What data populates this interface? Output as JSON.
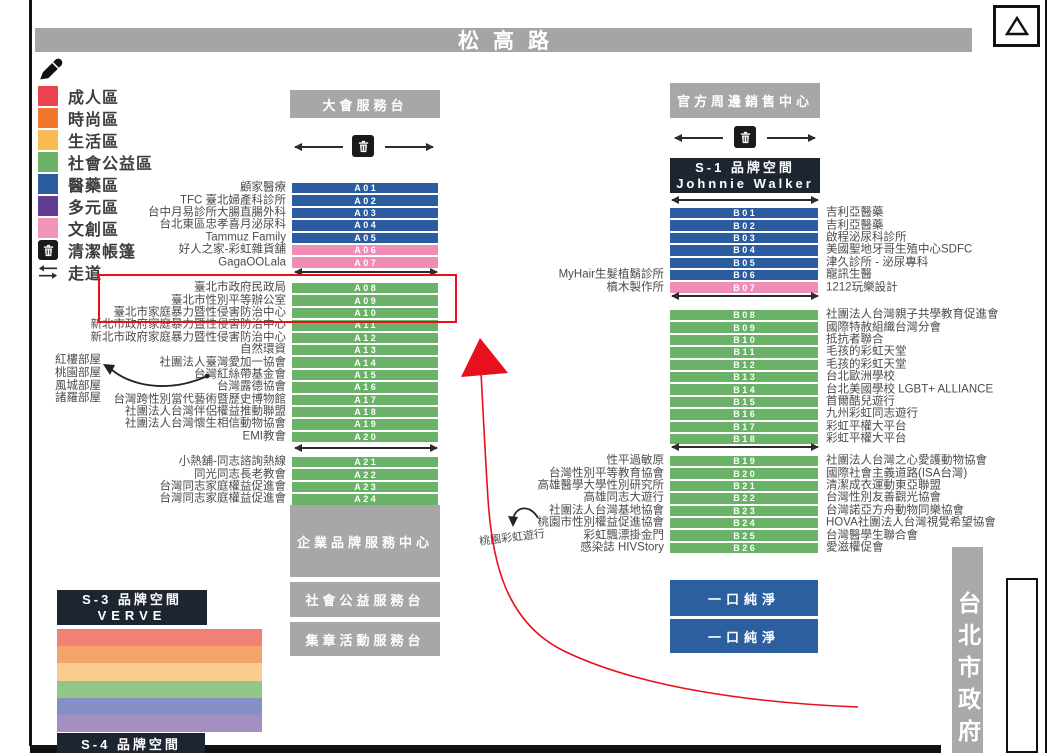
{
  "street": {
    "name": "松高路"
  },
  "legend": {
    "items": [
      {
        "label": "成人區",
        "color": "#e8434e"
      },
      {
        "label": "時尚區",
        "color": "#f2762b"
      },
      {
        "label": "生活區",
        "color": "#f8bc55"
      },
      {
        "label": "社會公益區",
        "color": "#6cb368"
      },
      {
        "label": "醫藥區",
        "color": "#2b5c9f"
      },
      {
        "label": "多元區",
        "color": "#613c90"
      },
      {
        "label": "文創區",
        "color": "#f294ba"
      }
    ],
    "trash_label": "清潔帳篷",
    "aisle_label": "走道",
    "aisle_glyph": "⇆"
  },
  "zones": {
    "info_desk": "大會服務台",
    "merch_center": "官方周邊銷售中心",
    "s1_line1": "S-1 品牌空間",
    "s1_line2": "Johnnie Walker",
    "s3_line1": "S-3 品牌空間",
    "s3_line2": "VERVE",
    "s4_line1": "S-4 品牌空間",
    "corp_center": "企業品牌服務中心",
    "social_desk": "社會公益服務台",
    "stamp_desk": "集章活動服務台",
    "pure_sip_1": "一口純淨",
    "pure_sip_2": "一口純淨",
    "city_hall": "台北市政府",
    "triangle_marker": "△"
  },
  "booths": {
    "a1": [
      {
        "code": "A01",
        "label_left": "顧家醫療",
        "color": "#2b5c9f"
      },
      {
        "code": "A02",
        "label_left": "TFC 臺北婦產科診所",
        "color": "#2b5c9f"
      },
      {
        "code": "A03",
        "label_left": "台中月易診所大腸直腸外科",
        "color": "#2b5c9f"
      },
      {
        "code": "A04",
        "label_left": "台北東區忠孝喜月泌尿科",
        "color": "#2b5c9f"
      },
      {
        "code": "A05",
        "label_left": "Tammuz Family",
        "color": "#2b5c9f"
      },
      {
        "code": "A06",
        "label_left": "好人之家-彩虹雜貨舖",
        "color": "#f18cb7"
      },
      {
        "code": "A07",
        "label_left": "GagaOOLala",
        "color": "#f18cb7"
      }
    ],
    "a2": [
      {
        "code": "A08",
        "label_left": "臺北市政府民政局",
        "color": "#69b267"
      },
      {
        "code": "A09",
        "label_left": "臺北市性別平等辦公室",
        "color": "#69b267"
      },
      {
        "code": "A10",
        "label_left": "臺北市家庭暴力暨性侵害防治中心",
        "color": "#69b267"
      },
      {
        "code": "A11",
        "label_left": "新北市政府家庭暴力暨性侵害防治中心",
        "color": "#69b267"
      },
      {
        "code": "A12",
        "label_left": "新北市政府家庭暴力暨性侵害防治中心",
        "color": "#69b267"
      },
      {
        "code": "A13",
        "label_left": "自然環資",
        "color": "#69b267"
      },
      {
        "code": "A14",
        "label_left": "社團法人臺灣愛加一協會",
        "color": "#69b267"
      },
      {
        "code": "A15",
        "label_left": "台灣紅絲帶基金會",
        "color": "#69b267"
      },
      {
        "code": "A16",
        "label_left": "台灣露德協會",
        "color": "#69b267"
      },
      {
        "code": "A17",
        "label_left": "台灣跨性別當代藝術暨歷史博物館",
        "color": "#69b267"
      },
      {
        "code": "A18",
        "label_left": "社團法人台灣伴侶權益推動聯盟",
        "color": "#69b267"
      },
      {
        "code": "A19",
        "label_left": "社團法人台灣懷生相信動物協會",
        "color": "#69b267"
      },
      {
        "code": "A20",
        "label_left": "EMI教會",
        "color": "#69b267"
      }
    ],
    "a3": [
      {
        "code": "A21",
        "label_left": "小熱舖-同志諮詢熱線",
        "color": "#69b267"
      },
      {
        "code": "A22",
        "label_left": "同光同志長老教會",
        "color": "#69b267"
      },
      {
        "code": "A23",
        "label_left": "台灣同志家庭權益促進會",
        "color": "#69b267"
      },
      {
        "code": "A24",
        "label_left": "台灣同志家庭權益促進會",
        "color": "#69b267"
      }
    ],
    "b1": [
      {
        "code": "B01",
        "label_right": "吉利亞醫藥",
        "color": "#2b5c9f"
      },
      {
        "code": "B02",
        "label_right": "吉利亞醫藥",
        "color": "#2b5c9f"
      },
      {
        "code": "B03",
        "label_right": "啟程泌尿科診所",
        "color": "#2b5c9f"
      },
      {
        "code": "B04",
        "label_right": "美國聖地牙哥生殖中心SDFC",
        "color": "#2b5c9f"
      },
      {
        "code": "B05",
        "label_right": "津久診所 - 泌尿專科",
        "color": "#2b5c9f"
      },
      {
        "code": "B06",
        "label_left": "MyHair生髮植鬍診所",
        "label_right": "寵訊生醫",
        "color": "#2b5c9f"
      },
      {
        "code": "B07",
        "label_left": "槙木製作所",
        "label_right": "1212玩樂設計",
        "color": "#f18cb7"
      }
    ],
    "b2": [
      {
        "code": "B08",
        "label_right": "社團法人台灣親子共學教育促進會",
        "color": "#69b267"
      },
      {
        "code": "B09",
        "label_right": "國際特赦組織台灣分會",
        "color": "#69b267"
      },
      {
        "code": "B10",
        "label_right": "抵抗者聯合",
        "color": "#69b267"
      },
      {
        "code": "B11",
        "label_right": "毛孩的彩虹天堂",
        "color": "#69b267"
      },
      {
        "code": "B12",
        "label_right": "毛孩的彩虹天堂",
        "color": "#69b267"
      },
      {
        "code": "B13",
        "label_right": "台北歐洲學校",
        "color": "#69b267"
      },
      {
        "code": "B14",
        "label_right": "台北美國學校 LGBT+ ALLIANCE",
        "color": "#69b267"
      },
      {
        "code": "B15",
        "label_right": "首爾酷兒遊行",
        "color": "#69b267"
      },
      {
        "code": "B16",
        "label_right": "九州彩虹同志遊行",
        "color": "#69b267"
      },
      {
        "code": "B17",
        "label_right": "彩虹平權大平台",
        "color": "#69b267"
      },
      {
        "code": "B18",
        "label_right": "彩虹平權大平台",
        "color": "#69b267"
      }
    ],
    "b3": [
      {
        "code": "B19",
        "label_left": "性平過敏原",
        "label_right": "社團法人台灣之心愛護動物協會",
        "color": "#69b267"
      },
      {
        "code": "B20",
        "label_left": "台灣性別平等教育協會",
        "label_right": "國際社會主義道路(ISA台灣)",
        "color": "#69b267"
      },
      {
        "code": "B21",
        "label_left": "高雄醫學大學性別研究所",
        "label_right": "清潔成衣運動東亞聯盟",
        "color": "#69b267"
      },
      {
        "code": "B22",
        "label_left": "高雄同志大遊行",
        "label_right": "台灣性別友善觀光協會",
        "color": "#69b267"
      },
      {
        "code": "B23",
        "label_left": "社團法人台灣基地協會",
        "label_right": "台灣諾亞方舟動物同樂協會",
        "color": "#69b267"
      },
      {
        "code": "B24",
        "label_left": "桃園市性別權益促進協會",
        "label_right": "HOVA社團法人台灣視覺希望協會",
        "color": "#69b267"
      },
      {
        "code": "B25",
        "label_left": "彩虹飄漂掛金門",
        "label_right": "台灣醫學生聯合會",
        "color": "#69b267"
      },
      {
        "code": "B26",
        "label_left": "感染誌 HIVStory",
        "label_right": "愛滋權促會",
        "color": "#69b267"
      }
    ]
  },
  "annotations": {
    "rooms": [
      {
        "label": "紅樓部屋"
      },
      {
        "label": "桃園部屋"
      },
      {
        "label": "風城部屋"
      },
      {
        "label": "諸羅部屋"
      }
    ],
    "taoyuan_pride_label": "桃園彩虹遊行",
    "highlight_color": "#e8101c"
  },
  "rainbow_stripes": [
    {
      "color": "#ef8176"
    },
    {
      "color": "#f5a36b"
    },
    {
      "color": "#f8cd8f"
    },
    {
      "color": "#93c687"
    },
    {
      "color": "#8591c6"
    },
    {
      "color": "#a58fc0"
    }
  ]
}
